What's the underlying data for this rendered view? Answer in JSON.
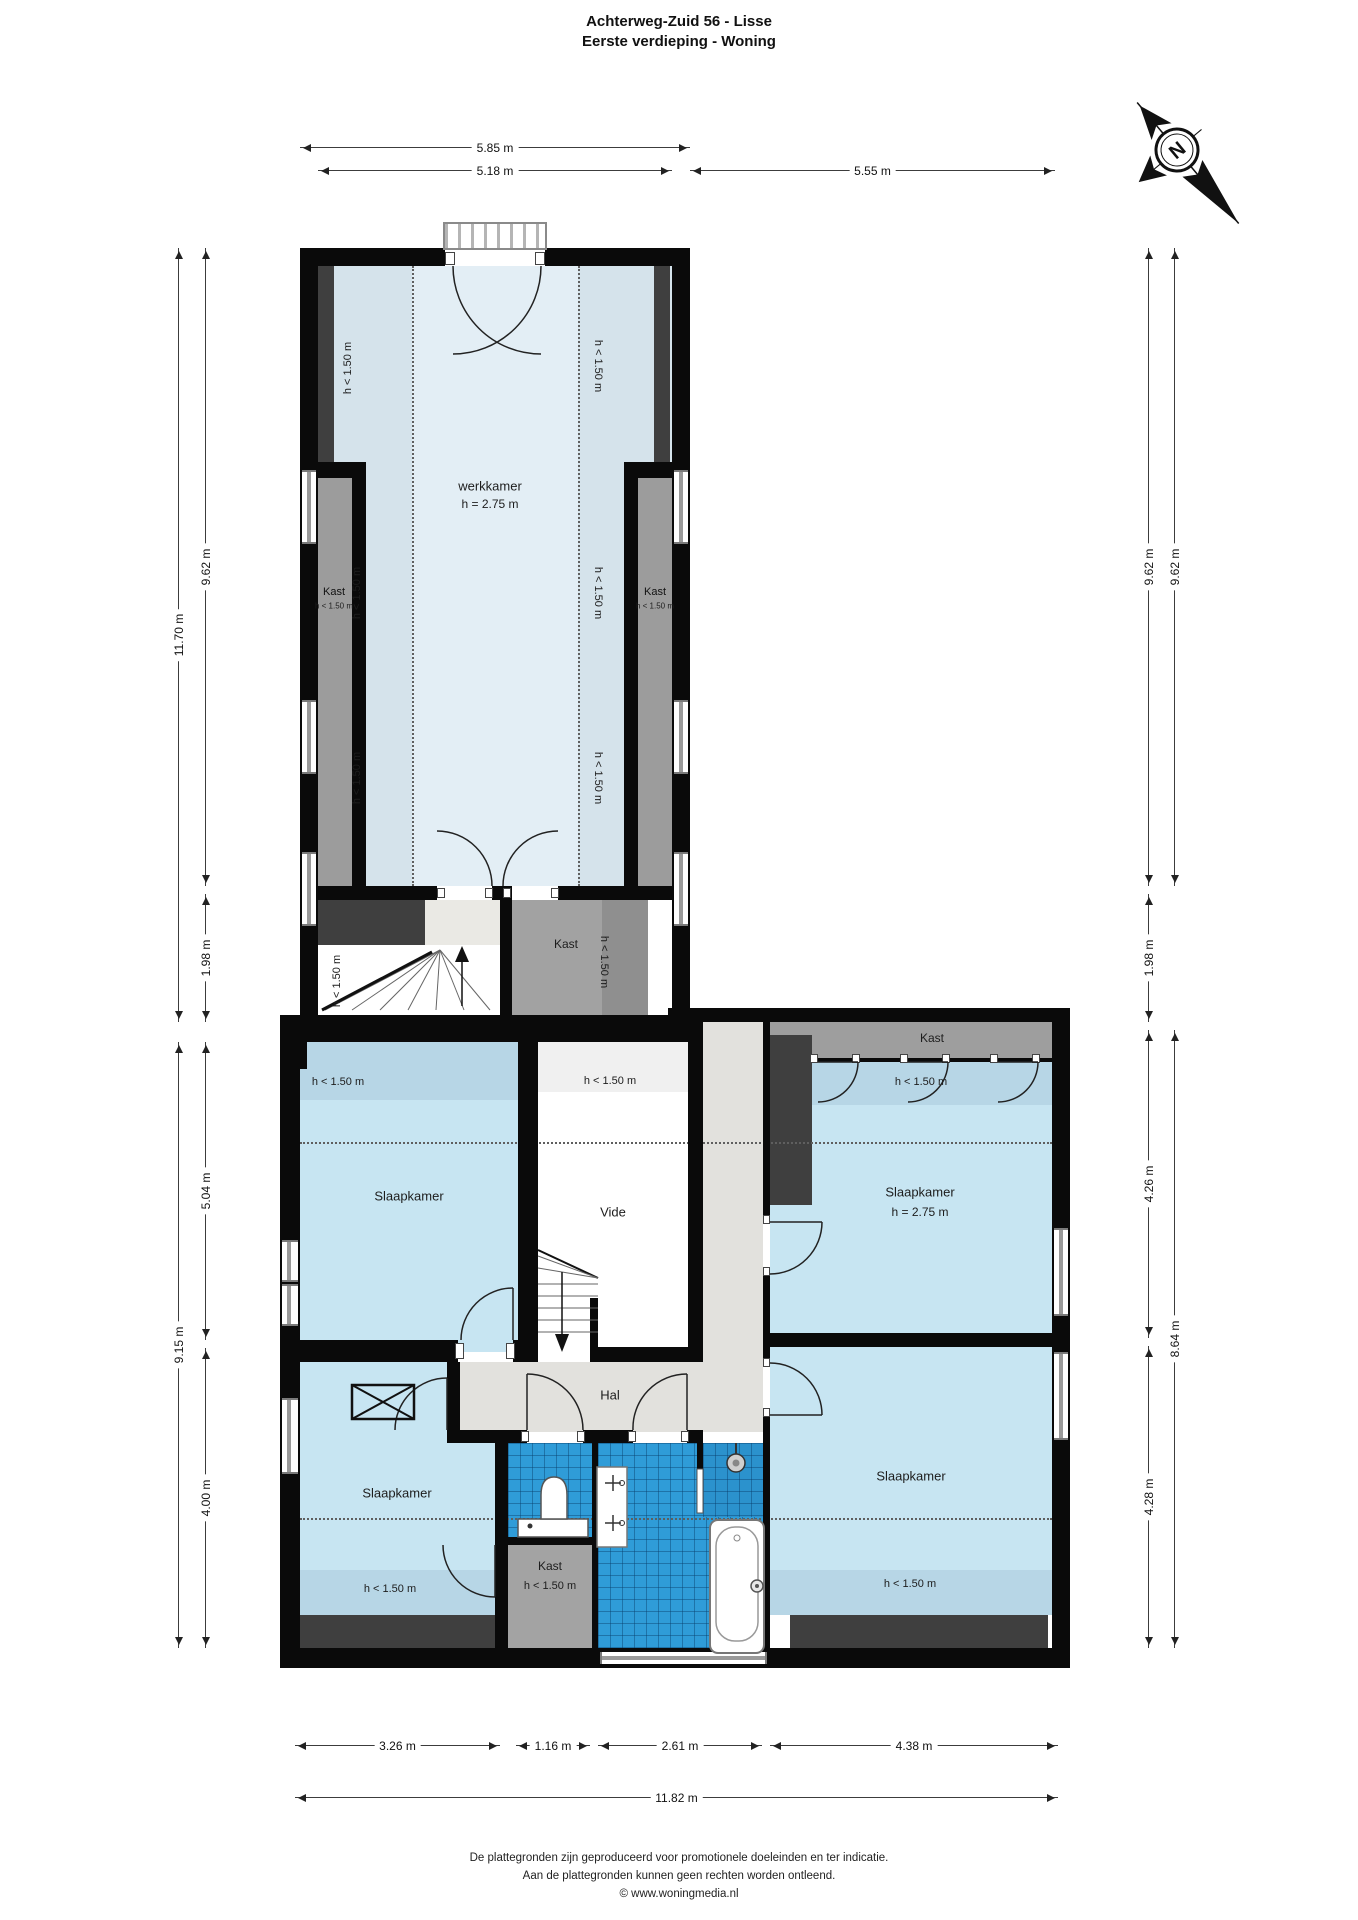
{
  "title": {
    "line1": "Achterweg-Zuid 56 - Lisse",
    "line2": "Eerste verdieping - Woning"
  },
  "compass": {
    "north": "N"
  },
  "labels": {
    "werkkamer": "werkkamer",
    "werkkamer_height": "h = 2.75 m",
    "kast": "Kast",
    "low_height": "h < 1.50 m",
    "slaapkamer": "Slaapkamer",
    "slaapkamer_height": "h = 2.75 m",
    "vide": "Vide",
    "hal": "Hal"
  },
  "dimensions": {
    "top": [
      "5.85 m",
      "5.18 m",
      "5.55 m"
    ],
    "left": [
      "11.70 m",
      "9.62 m",
      "1.98 m",
      "9.15 m",
      "5.04 m",
      "4.00 m"
    ],
    "right": [
      "9.62 m",
      "9.62 m",
      "1.98 m",
      "4.26 m",
      "4.28 m",
      "8.64 m"
    ],
    "bottom": [
      "3.26 m",
      "1.16 m",
      "2.61 m",
      "4.38 m",
      "11.82 m"
    ]
  },
  "footer": {
    "line1": "De plattegronden zijn geproduceerd voor promotionele doeleinden en ter indicatie.",
    "line2": "Aan de plattegronden kunnen geen rechten worden ontleend.",
    "line3": "© www.woningmedia.nl"
  },
  "colors": {
    "wall": "#0a0a0a",
    "bedroom_blue": "#c7e5f2",
    "bedroom_blue_low": "#b7d6e6",
    "werkkamer_blue": "#e3eef5",
    "werkkamer_low": "#d5e3eb",
    "hal_gray": "#e2e1dd",
    "closet_gray": "#9c9c9c",
    "dark_gray": "#3f3f3f",
    "tile_blue": "#2f9cd8",
    "vide_low": "#f0f0f0",
    "landing": "#eae9e4"
  }
}
